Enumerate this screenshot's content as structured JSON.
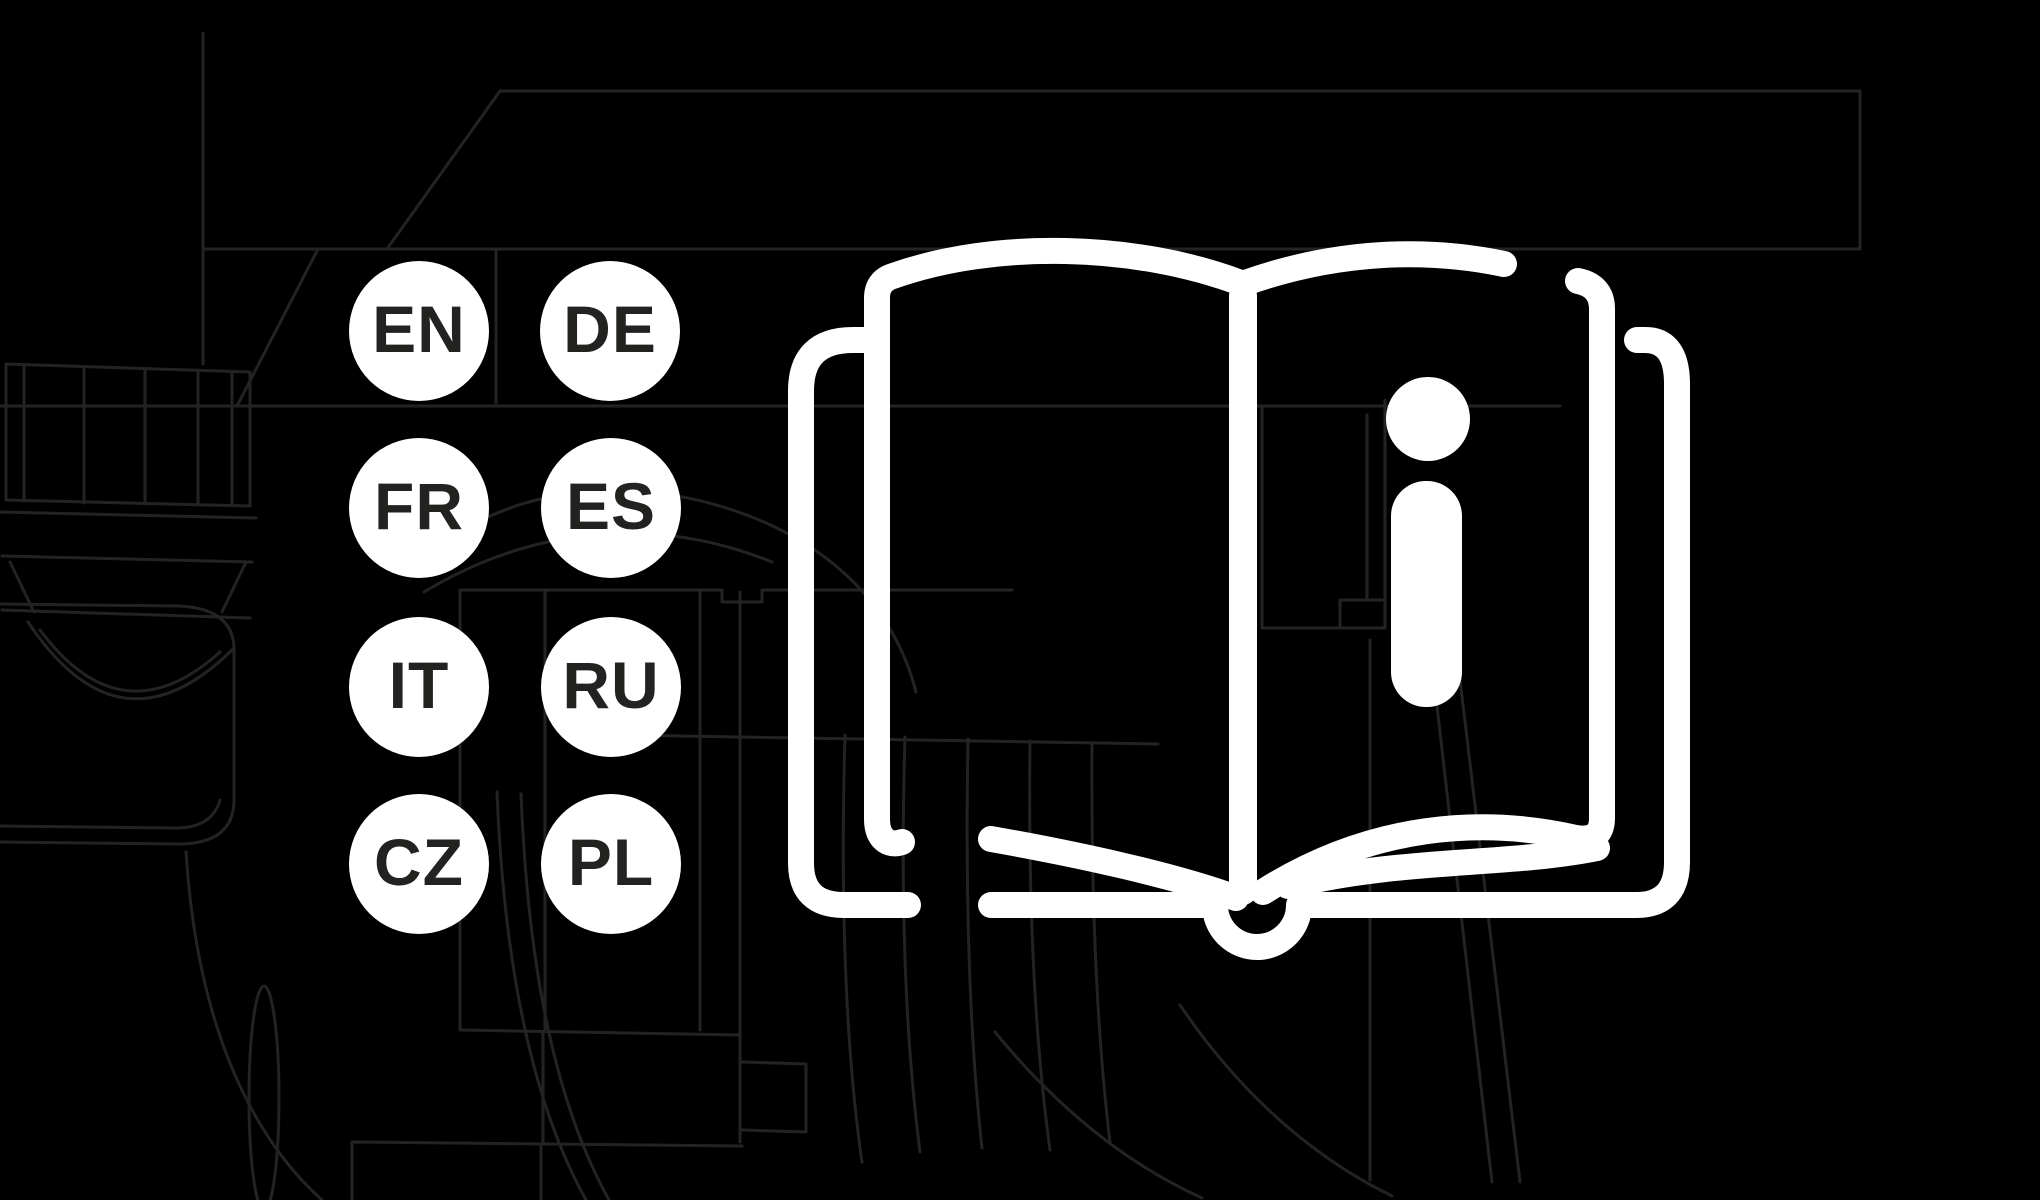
{
  "canvas": {
    "width": 2040,
    "height": 1200,
    "background_color": "#000000"
  },
  "palette": {
    "badge_fill": "#ffffff",
    "badge_text": "#222220",
    "book_icon_stroke": "#ffffff",
    "pump_outline_stroke": "#232323"
  },
  "language_badges": [
    {
      "code": "EN"
    },
    {
      "code": "DE"
    },
    {
      "code": "FR"
    },
    {
      "code": "ES"
    },
    {
      "code": "IT"
    },
    {
      "code": "RU"
    },
    {
      "code": "CZ"
    },
    {
      "code": "PL"
    }
  ],
  "book_icon": {
    "info_symbol": "i"
  }
}
